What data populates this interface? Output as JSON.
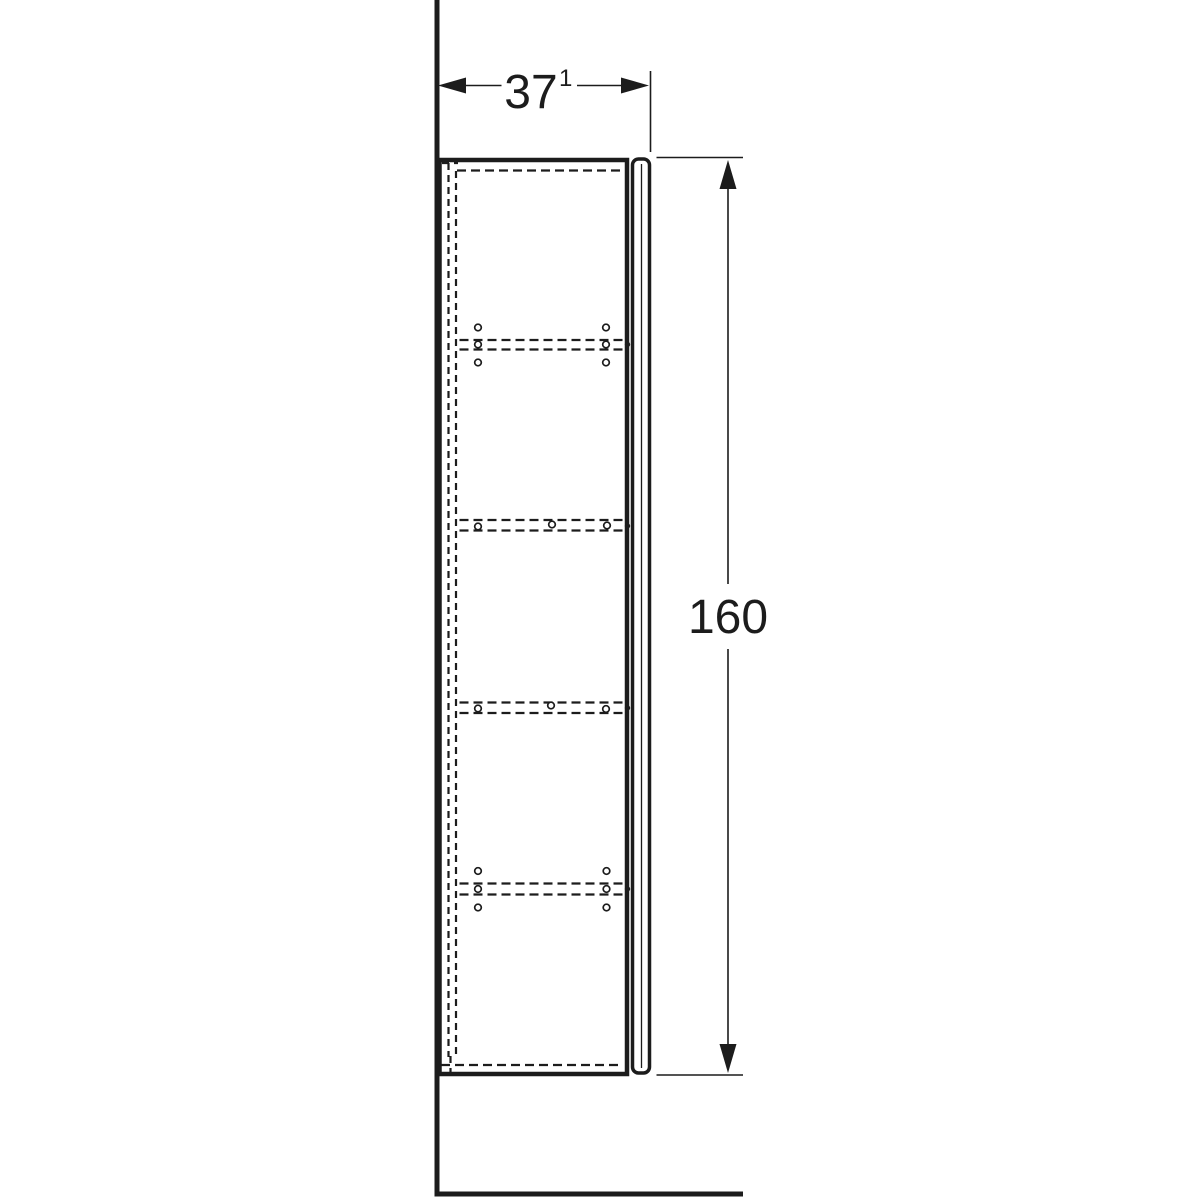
{
  "colors": {
    "line": "#1c1c1c",
    "background": "#ffffff"
  },
  "dimensions": {
    "width": {
      "value": "37",
      "superscript": "1"
    },
    "height": {
      "value": "160"
    }
  },
  "icons": {
    "width_arrow_left": "arrowhead-left",
    "width_arrow_right": "arrowhead-right",
    "height_arrow_up": "arrowhead-up",
    "height_arrow_down": "arrowhead-down"
  }
}
